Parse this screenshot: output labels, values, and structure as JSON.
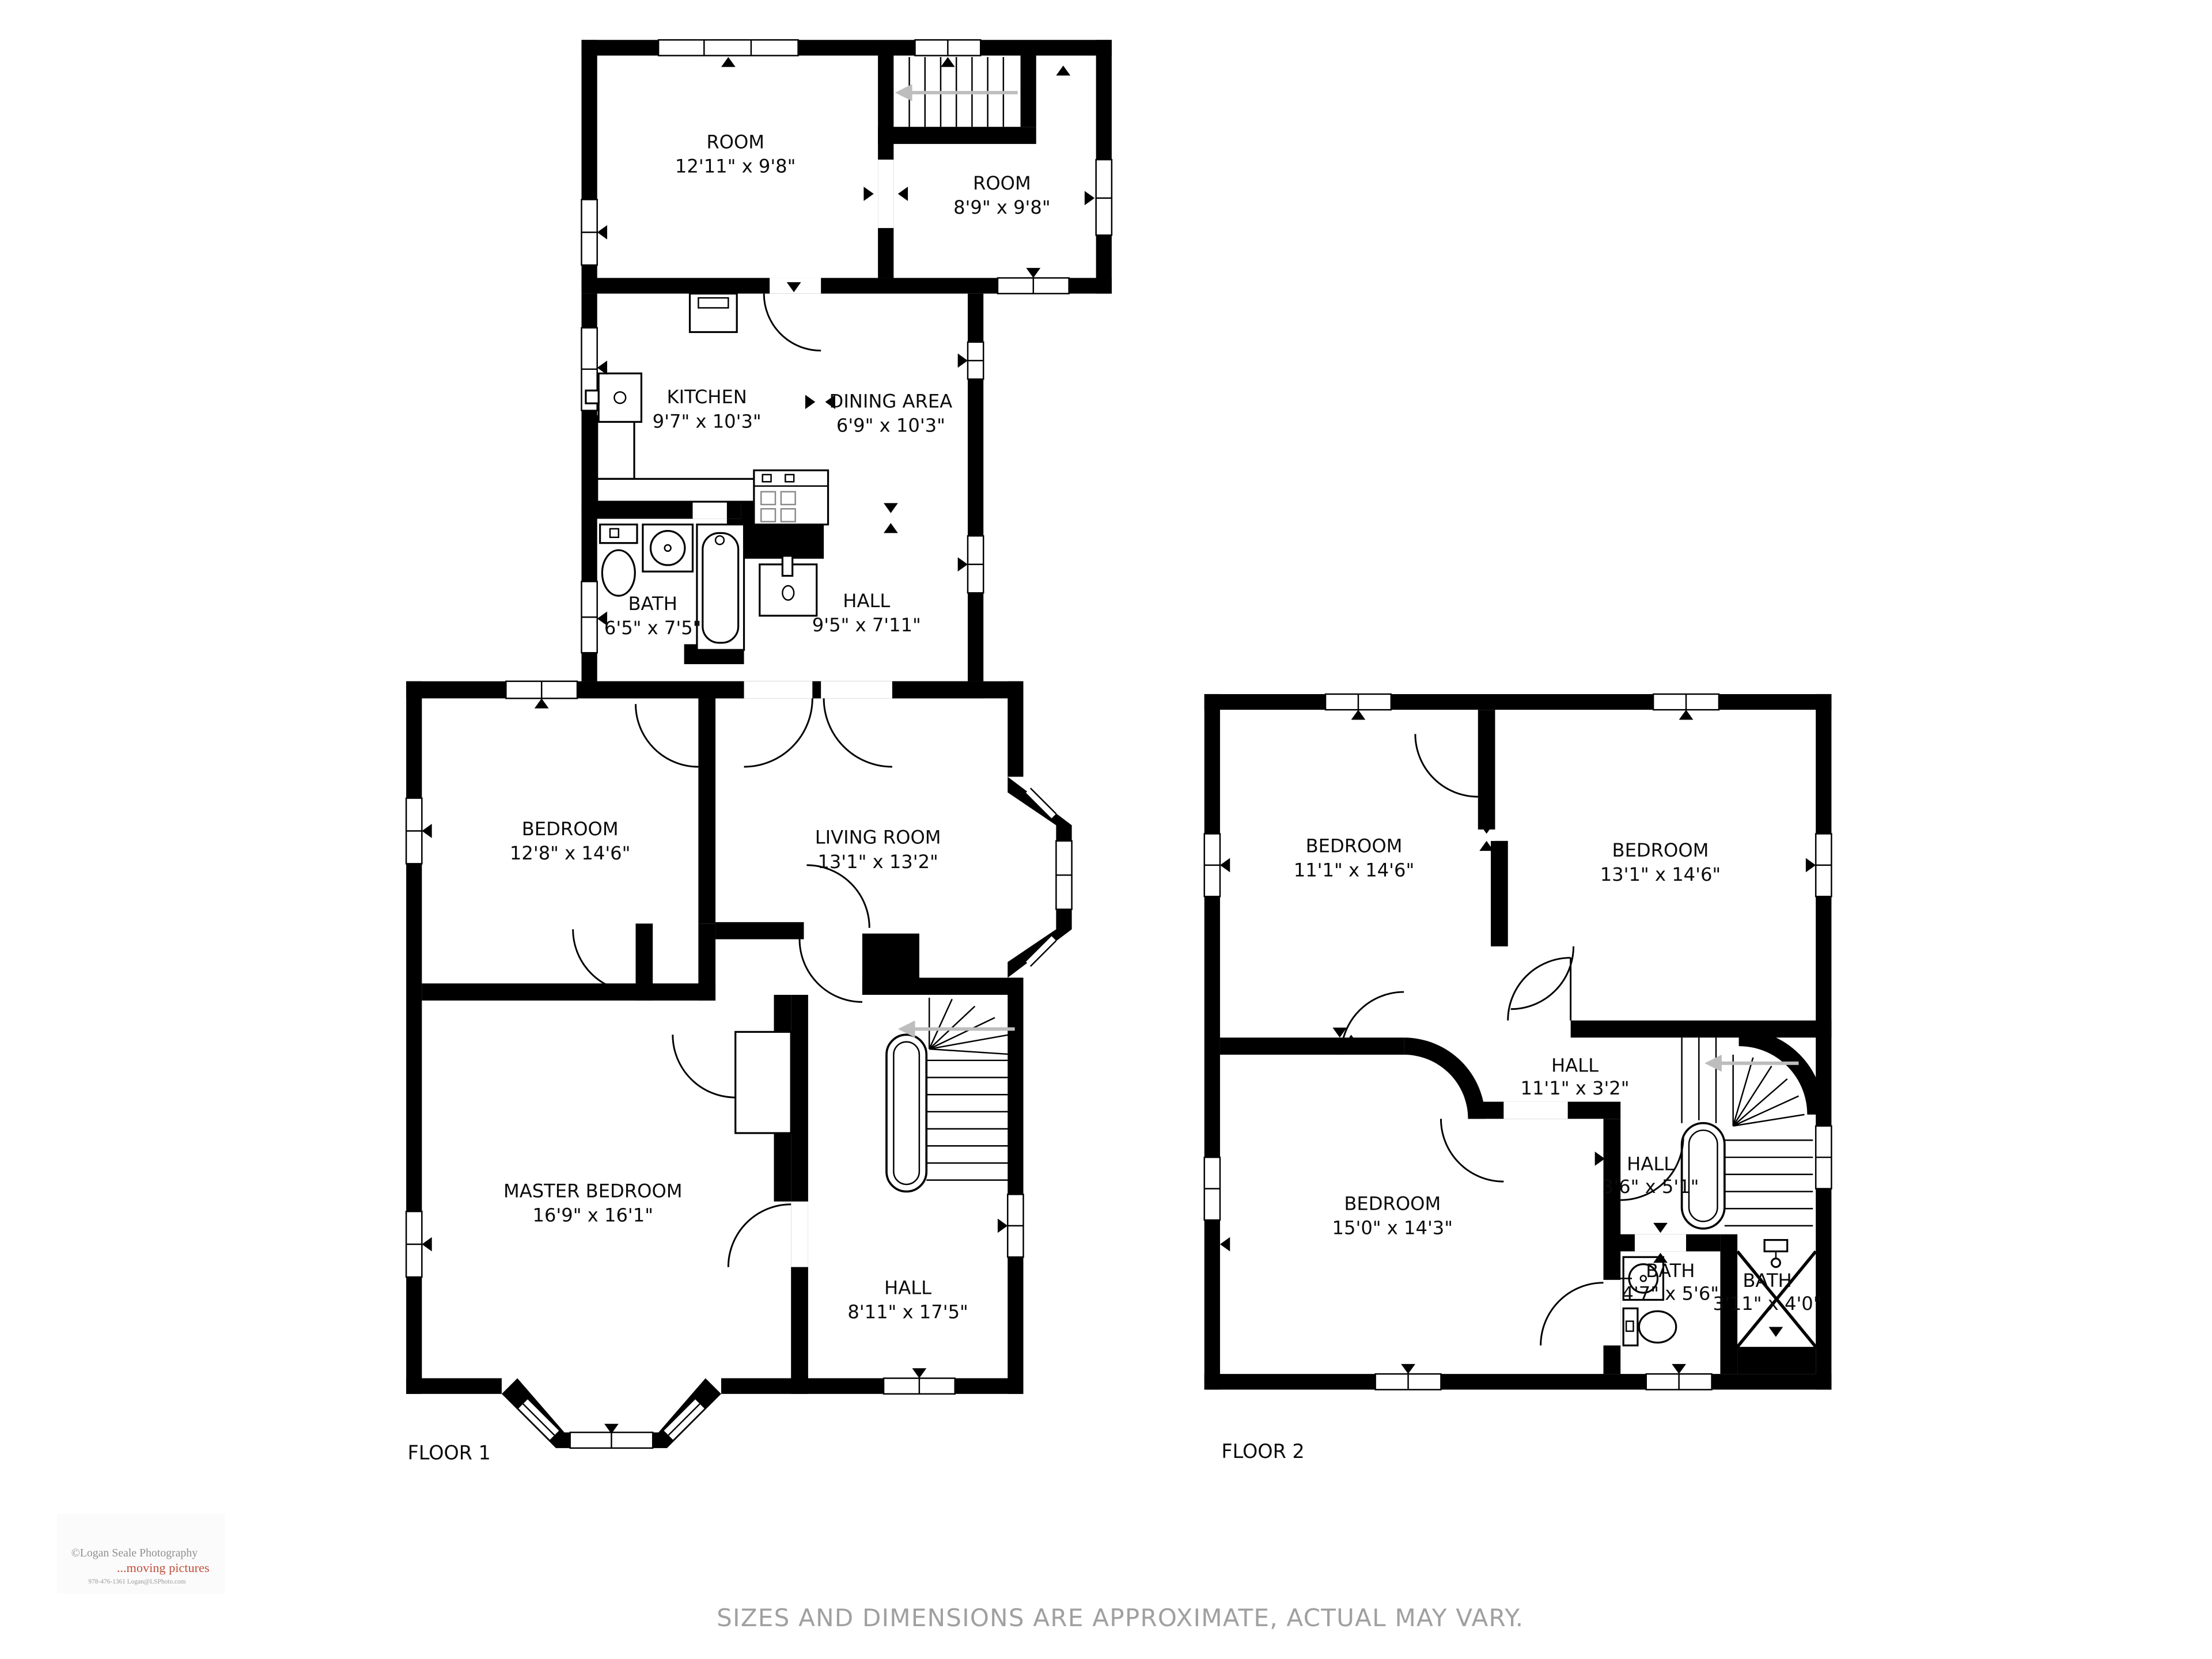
{
  "floors": [
    {
      "name": "FLOOR 1",
      "rooms": [
        {
          "name": "ROOM",
          "dims": "12'11\" x 9'8\""
        },
        {
          "name": "ROOM",
          "dims": "8'9\" x 9'8\""
        },
        {
          "name": "KITCHEN",
          "dims": "9'7\" x 10'3\""
        },
        {
          "name": "DINING AREA",
          "dims": "6'9\" x 10'3\""
        },
        {
          "name": "BATH",
          "dims": "6'5\" x 7'5\""
        },
        {
          "name": "HALL",
          "dims": "9'5\" x 7'11\""
        },
        {
          "name": "BEDROOM",
          "dims": "12'8\" x 14'6\""
        },
        {
          "name": "LIVING ROOM",
          "dims": "13'1\" x 13'2\""
        },
        {
          "name": "MASTER BEDROOM",
          "dims": "16'9\" x 16'1\""
        },
        {
          "name": "HALL",
          "dims": "8'11\" x 17'5\""
        }
      ]
    },
    {
      "name": "FLOOR 2",
      "rooms": [
        {
          "name": "BEDROOM",
          "dims": "11'1\" x 14'6\""
        },
        {
          "name": "BEDROOM",
          "dims": "13'1\" x 14'6\""
        },
        {
          "name": "HALL",
          "dims": "11'1\" x 3'2\""
        },
        {
          "name": "BEDROOM",
          "dims": "15'0\" x 14'3\""
        },
        {
          "name": "HALL",
          "dims": "3'6\" x 5'1\""
        },
        {
          "name": "BATH",
          "dims": "4'7\" x 5'6\""
        },
        {
          "name": "BATH",
          "dims": "3'11\" x 4'0\""
        }
      ]
    }
  ],
  "watermark": {
    "line1": "©Logan Seale Photography",
    "line2": "...moving pictures",
    "line3": "978-476-1361   Logan@LSPhoto.com"
  },
  "footer": {
    "disclaimer": "SIZES AND DIMENSIONS ARE APPROXIMATE, ACTUAL MAY VARY."
  }
}
